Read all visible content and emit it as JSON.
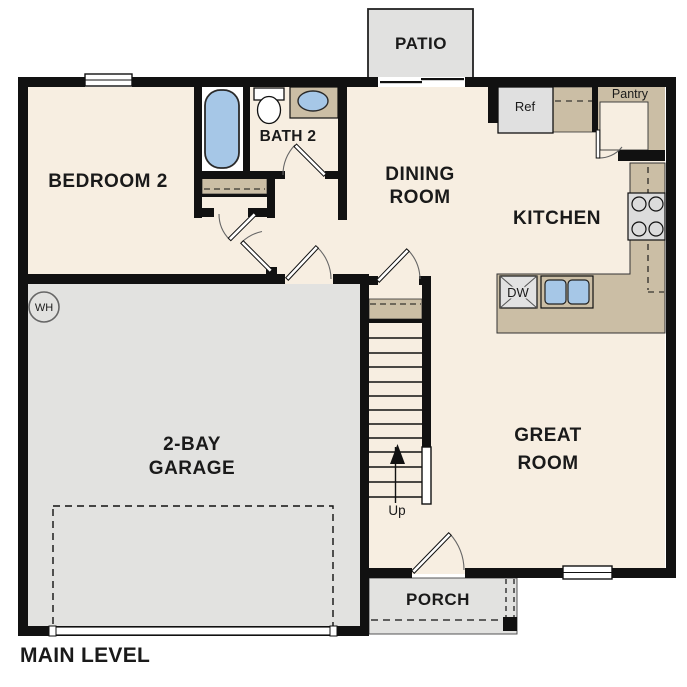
{
  "plan": {
    "title": "MAIN LEVEL",
    "rooms": {
      "patio": {
        "label": "PATIO"
      },
      "bedroom": {
        "label": "BEDROOM 2"
      },
      "bath": {
        "label": "BATH 2"
      },
      "dining": {
        "line1": "DINING",
        "line2": "ROOM"
      },
      "kitchen": {
        "label": "KITCHEN"
      },
      "pantry": {
        "label": "Pantry"
      },
      "great": {
        "line1": "GREAT",
        "line2": "ROOM"
      },
      "garage": {
        "line1": "2-BAY",
        "line2": "GARAGE"
      },
      "porch": {
        "label": "PORCH"
      }
    },
    "fixtures": {
      "ref": {
        "label": "Ref"
      },
      "dw": {
        "label": "DW"
      },
      "wh": {
        "label": "WH"
      },
      "up": {
        "label": "Up"
      }
    },
    "colors": {
      "floor": "#F7EEE1",
      "counter": "#CBBEA5",
      "concrete": "#E2E2E0",
      "fixture_blue": "#A6C7E7",
      "wall": "#111111"
    }
  }
}
